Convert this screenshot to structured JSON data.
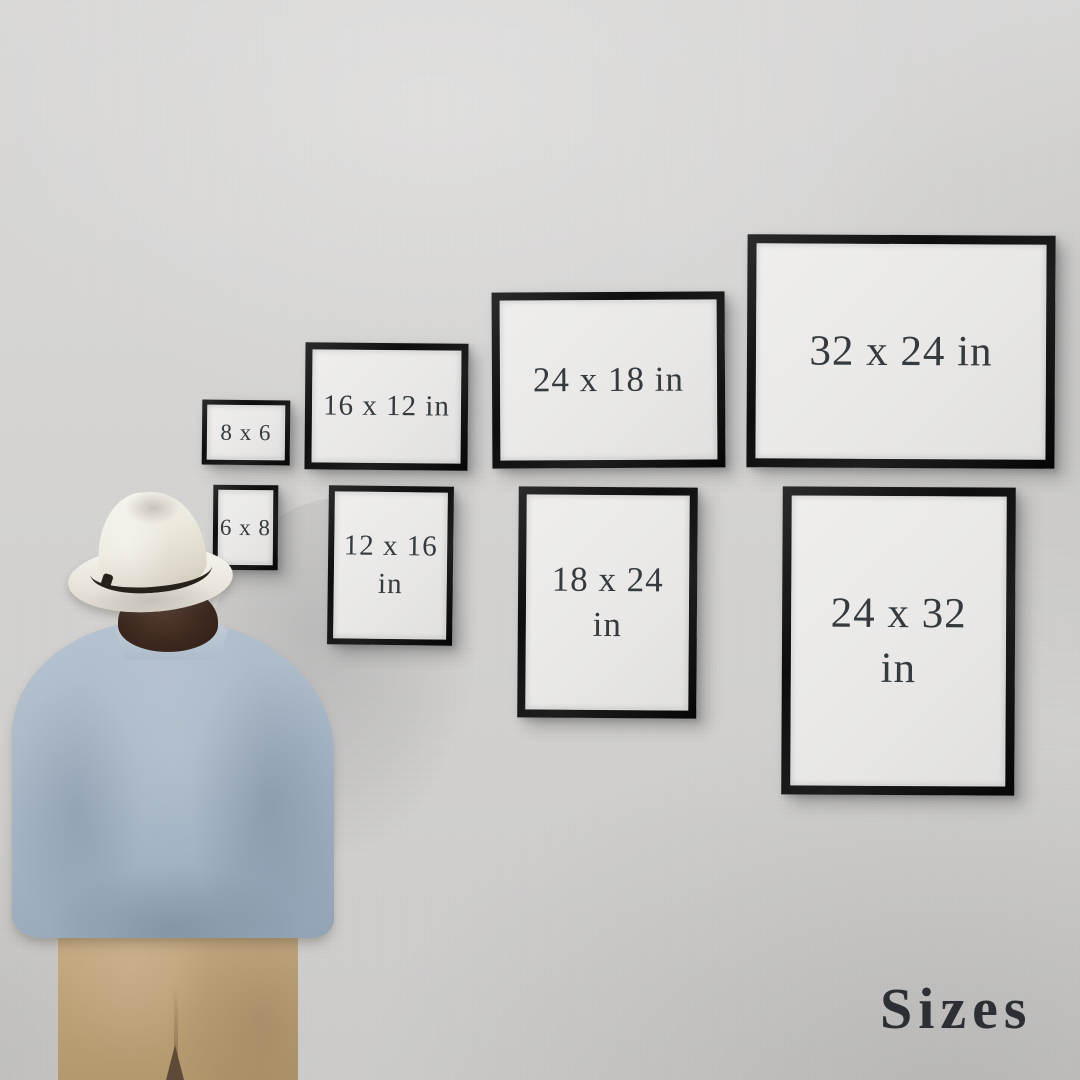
{
  "caption": "Sizes",
  "frames": [
    {
      "id": "8x6",
      "orientation": "landscape",
      "lines": [
        "8 x 6"
      ]
    },
    {
      "id": "16x12",
      "orientation": "landscape",
      "lines": [
        "16 x 12 in"
      ]
    },
    {
      "id": "24x18",
      "orientation": "landscape",
      "lines": [
        "24 x 18 in"
      ]
    },
    {
      "id": "32x24",
      "orientation": "landscape",
      "lines": [
        "32 x 24 in"
      ]
    },
    {
      "id": "6x8",
      "orientation": "portrait",
      "lines": [
        "6 x 8"
      ]
    },
    {
      "id": "12x16",
      "orientation": "portrait",
      "lines": [
        "12 x 16",
        "in"
      ]
    },
    {
      "id": "18x24",
      "orientation": "portrait",
      "lines": [
        "18 x 24",
        "in"
      ]
    },
    {
      "id": "24x32",
      "orientation": "portrait",
      "lines": [
        "24 x 32",
        "in"
      ]
    }
  ],
  "colors": {
    "wall": "#d5d4d2",
    "frame_border": "#121212",
    "frame_paper": "#e9e8e6",
    "label_text": "#343a3e",
    "caption_text": "#2c3034",
    "shirt": "#a9b7c6",
    "pants": "#c2a67c",
    "hat": "#efede7",
    "hat_band": "#262119"
  }
}
